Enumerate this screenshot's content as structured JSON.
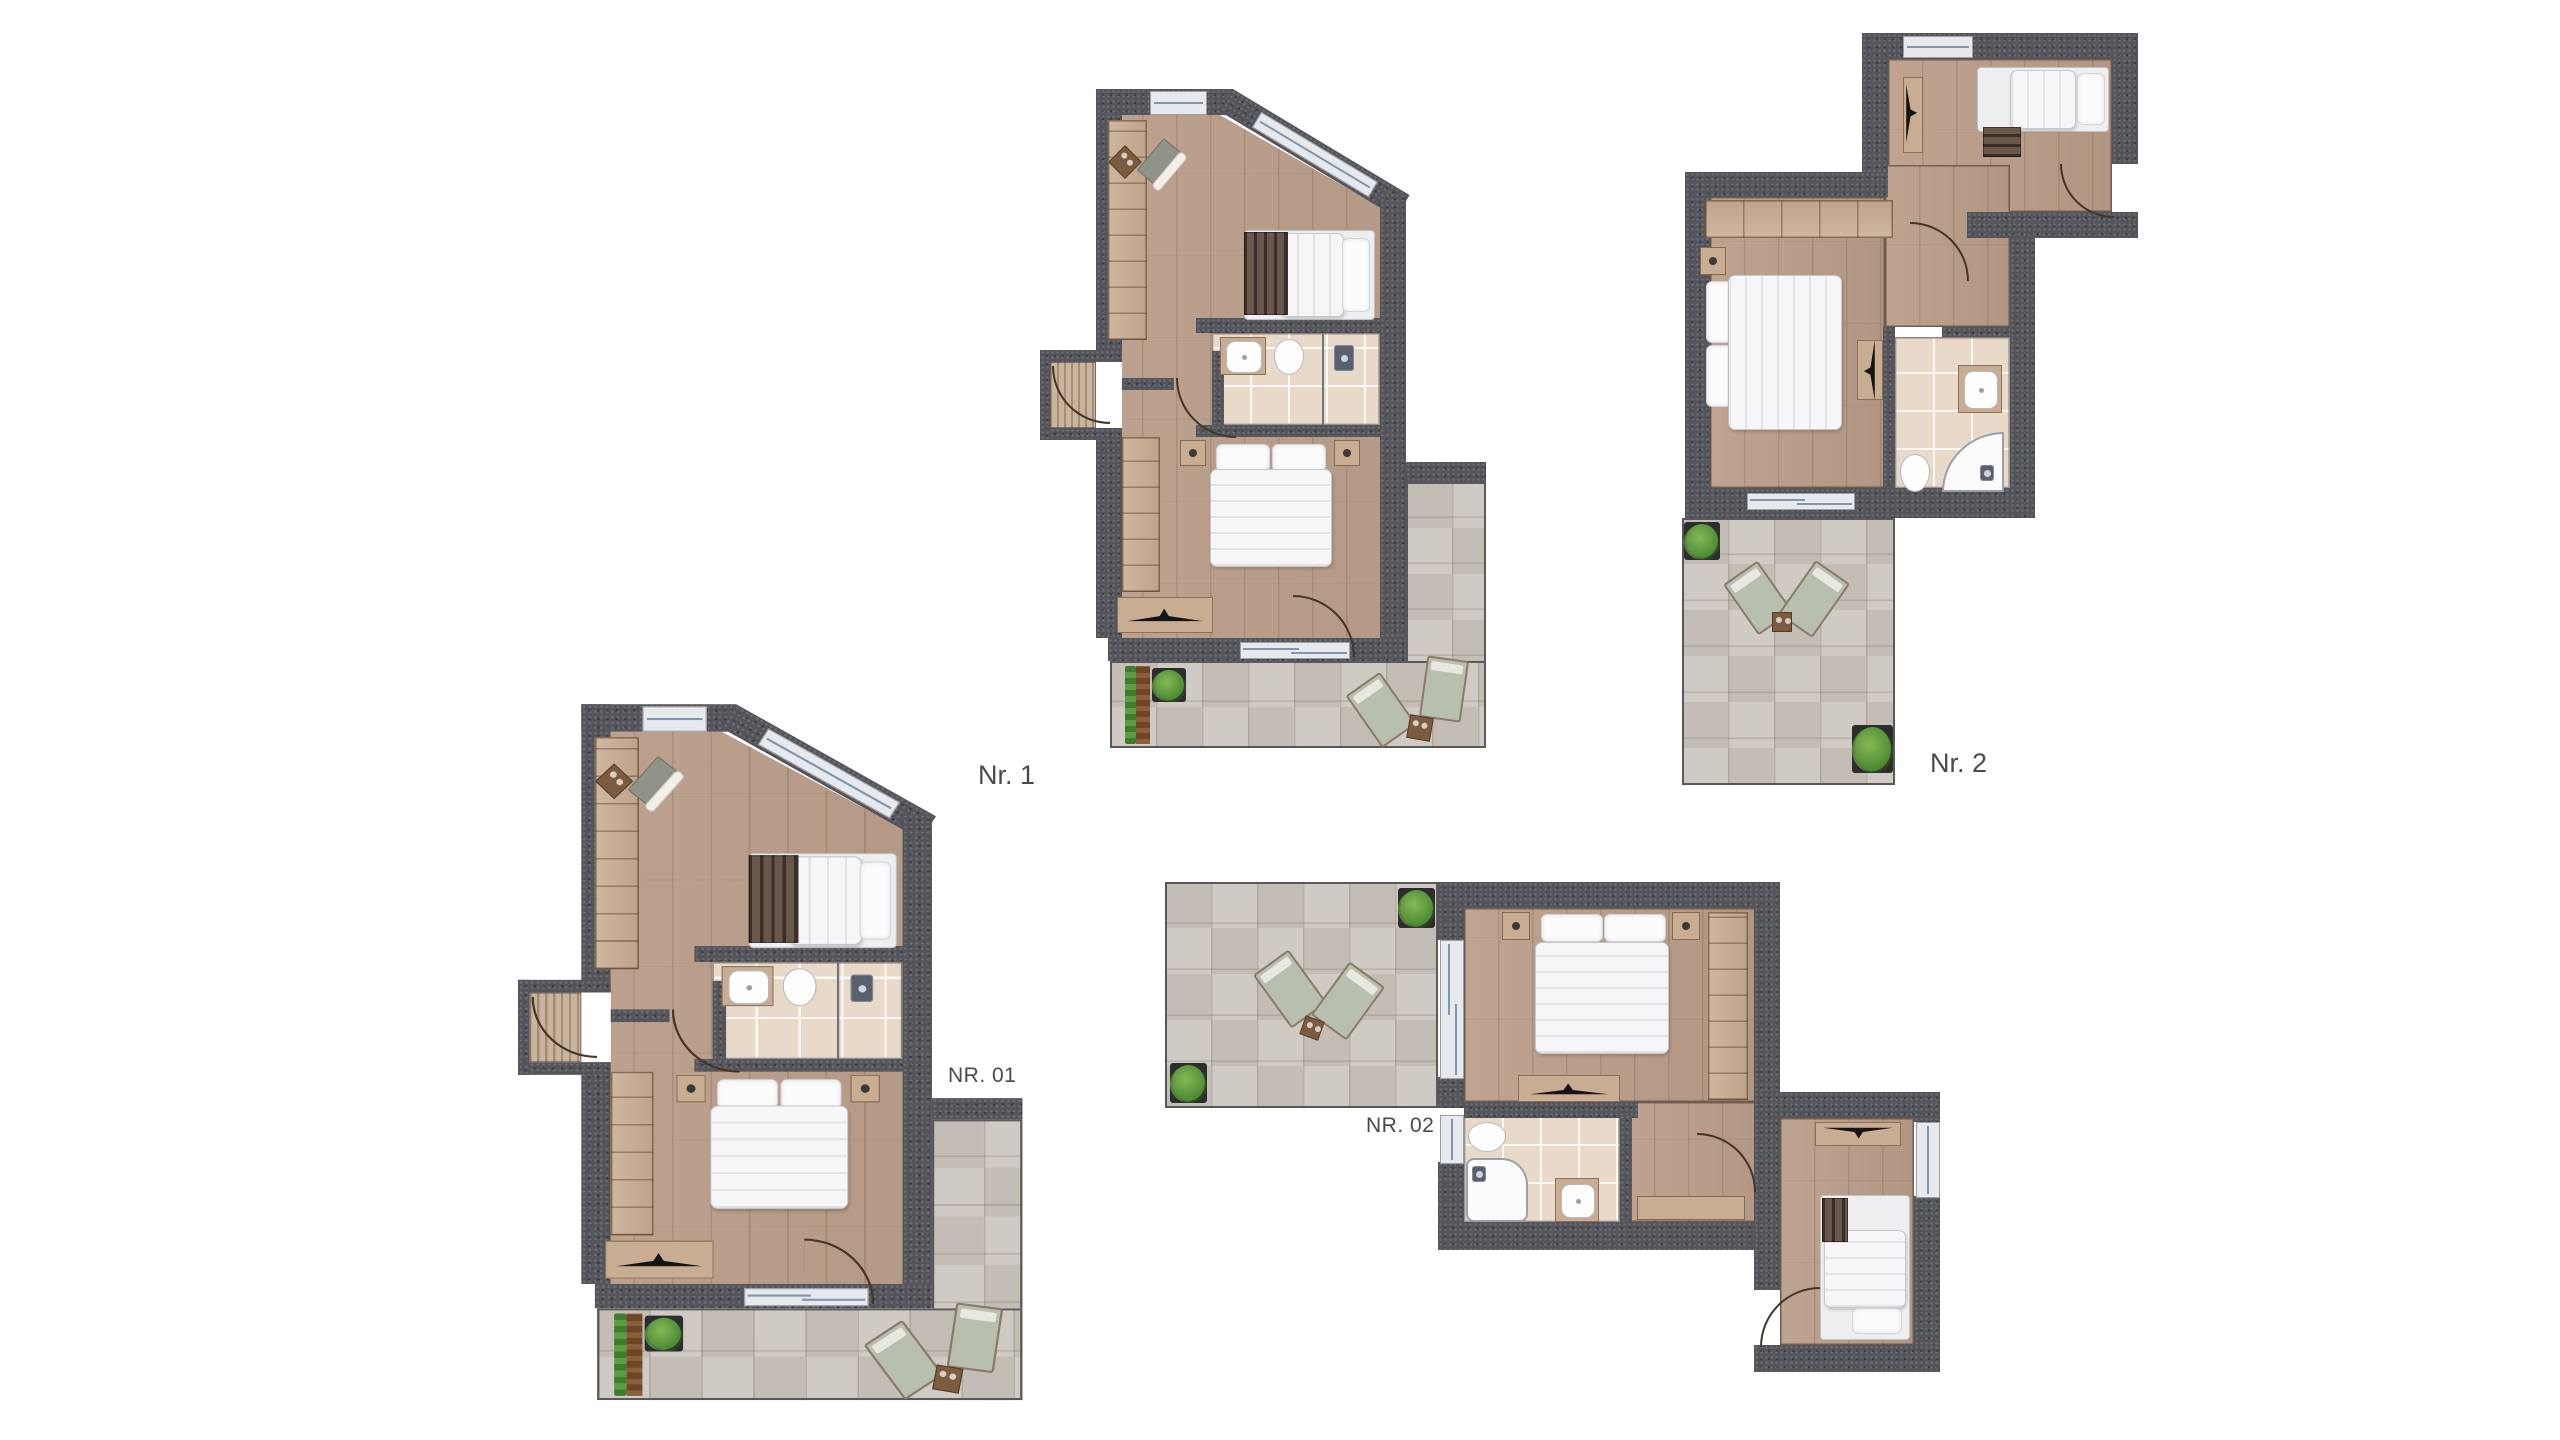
{
  "page": {
    "background": "#ffffff",
    "type": "architectural-floor-plan-sheet"
  },
  "plans": [
    {
      "name": "floor-plan-nr-1",
      "label": "Nr. 1"
    },
    {
      "name": "floor-plan-nr-2",
      "label": "Nr. 2"
    },
    {
      "name": "floor-plan-nr-01",
      "label": "NR. 01"
    },
    {
      "name": "floor-plan-nr-02",
      "label": "NR. 02"
    }
  ],
  "colors": {
    "wall": "#54555b",
    "wood_floor": "#bb9e8a",
    "terrace_tile": "#cdc7c0",
    "bathroom_tile": "#e9d9c9",
    "window_glass": "#e8e9ec",
    "window_line": "#7d97b0",
    "door_arc": "#43352a",
    "bedding": "#f6f6f8",
    "pillow": "#fcfcfd",
    "wardrobe_wood": "#c9ad92",
    "headboard_slats": "#6a564a",
    "tv_black": "#141414",
    "lounger_cushion": "#b7bfae",
    "lounger_frame": "#8b7a68",
    "plant_green": "#4c8a33",
    "plant_pot": "#2d2d2d",
    "planter_brown": "#8a5f3c",
    "hedge_green": "#3f7c2e",
    "label_text": "#4a4a4a"
  },
  "icons": [
    "double-bed",
    "single-bed",
    "pillow",
    "wardrobe",
    "closet-shelves",
    "tv-sideboard",
    "nightstand",
    "toilet",
    "sink-vanity",
    "shower-head",
    "glass-partition",
    "corner-shower",
    "shower-tray",
    "door-arc",
    "window",
    "sliding-door",
    "sun-lounger",
    "side-table",
    "potted-plant",
    "hedge-planter",
    "doormat",
    "armchair",
    "bench"
  ]
}
